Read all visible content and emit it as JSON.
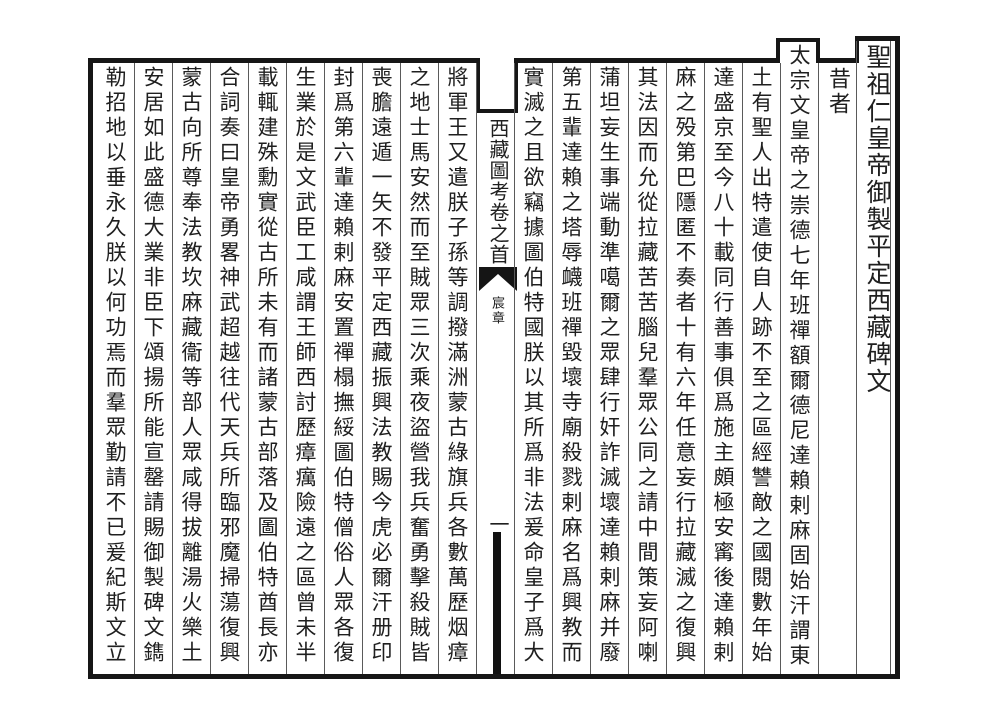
{
  "page": {
    "colors": {
      "paper": "#ffffff",
      "ink": "#1f1f1f",
      "rule": "#5a5a5a"
    },
    "heading_column": "聖祖仁皇帝御製平定西藏碑文",
    "opening": "昔者",
    "columns": [
      "太宗文皇帝之崇德七年班禪額爾德尼達賴剌麻固始汗謂東",
      "土有聖人出特遣使自人跡不至之區經讐敵之國閱數年始",
      "達盛京至今八十載同行善事俱爲施主頗極安寗後達賴剌",
      "麻之殁第巴隱匿不奏者十有六年任意妄行拉藏滅之復興",
      "其法因而允從拉藏苦苦腦兒羣眾公同之請中間策妄阿喇",
      "蒲坦妄生事端動準噶爾之眾肆行奸詐滅壞達賴剌麻并廢",
      "第五輩達賴之塔辱衊班禪毀壞寺廟殺戮剌麻名爲興教而",
      "實滅之且欲竊據圖伯特國朕以其所爲非法爰命皇子爲大",
      "將軍王又遣朕子孫等調撥滿洲蒙古綠旗兵各數萬歷烟瘴",
      "之地士馬安然而至賊眾三次乘夜盜營我兵奮勇擊殺賊皆",
      "喪膽遠遁一矢不發平定西藏振興法教賜今虎必爾汗册印",
      "封爲第六輩達賴剌麻安置禪榻撫綏圖伯特僧俗人眾各復",
      "生業於是文武臣工咸謂王師西討歷瘴癘險遠之區曾未半",
      "載輒建殊勳實從古所未有而諸蒙古部落及圖伯特酋長亦",
      "合詞奏曰皇帝勇畧神武超越往代天兵所臨邪魔掃蕩復興",
      "蒙古向所尊奉法教坎麻藏衞等部人眾咸得拔離湯火樂土",
      "安居如此盛德大業非臣下頌揚所能宣罄請賜御製碑文鐫",
      "勒招地以垂永久朕以何功焉而羣眾勤請不已爰紀斯文立"
    ],
    "center_column": {
      "book_title": "西藏圖考卷之首",
      "section_label": "宸章",
      "page_number": "一"
    }
  }
}
